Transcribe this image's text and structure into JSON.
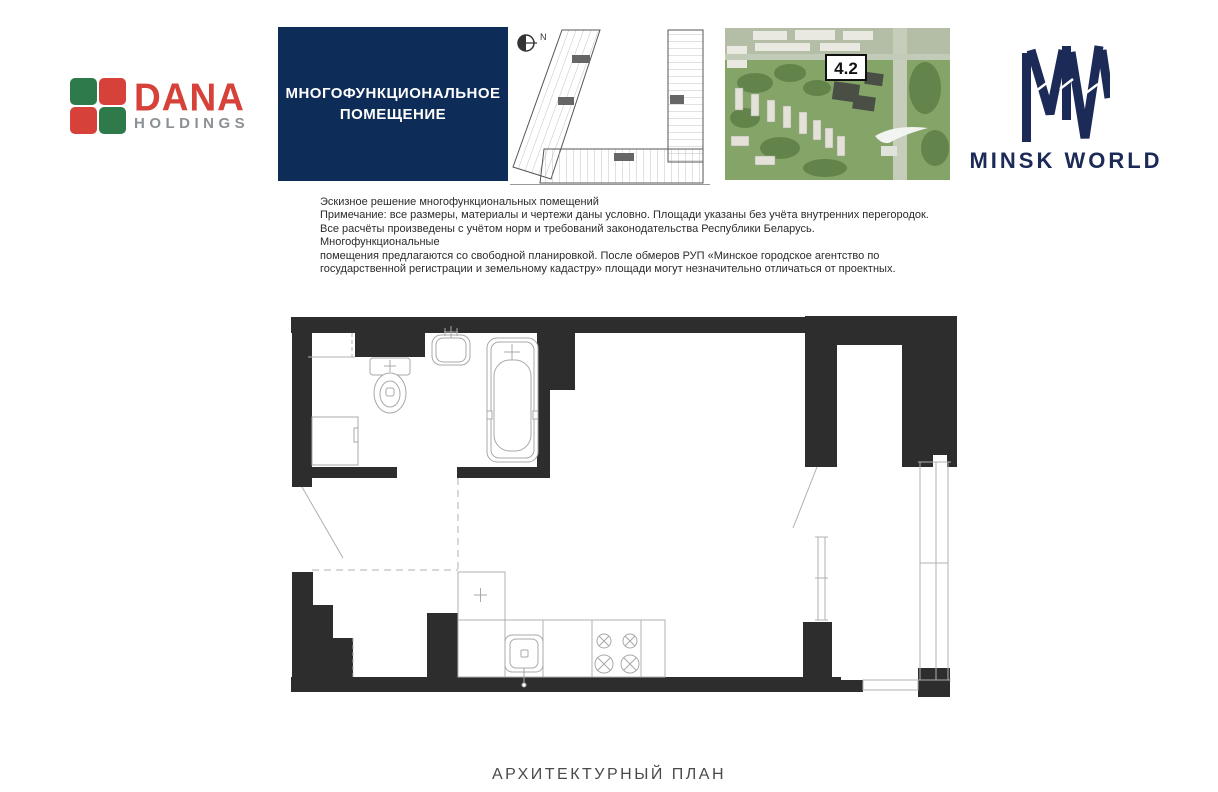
{
  "header": {
    "dana_logo": {
      "word": "DANA",
      "sub": "HOLDINGS"
    },
    "title_box": {
      "line1": "МНОГОФУНКЦИОНАЛЬНОЕ",
      "line2": "ПОМЕЩЕНИЕ"
    },
    "key_plan": {
      "north_label": "N"
    },
    "aerial": {
      "block_label": "4.2"
    },
    "minsk_world": {
      "monogram": "MW",
      "name": "MINSK WORLD"
    }
  },
  "notes": {
    "lines": [
      "Эскизное решение многофункциональных помещений",
      "Примечание: все размеры, материалы и чертежи даны условно. Площади указаны без учёта внутренних перегородок.",
      "Все расчёты произведены с учётом норм и требований законодательства Республики Беларусь. Многофункциональные",
      "помещения предлагаются со свободной планировкой. После обмеров РУП «Минское городское агентство по",
      "государственной регистрации и земельному кадастру» площади могут незначительно отличаться от проектных."
    ]
  },
  "footer": {
    "caption": "АРХИТЕКТУРНЫЙ ПЛАН"
  },
  "colors": {
    "title_box_navy": "#0e2c58",
    "minsk_world_navy": "#1b2a56",
    "dana_red": "#d6423a",
    "dana_green": "#2f7a4a",
    "dana_gray": "#8b9094",
    "plan_wall": "#2d2d2d",
    "plan_line": "#b0b0b0",
    "caption_gray": "#4a4a4a"
  }
}
